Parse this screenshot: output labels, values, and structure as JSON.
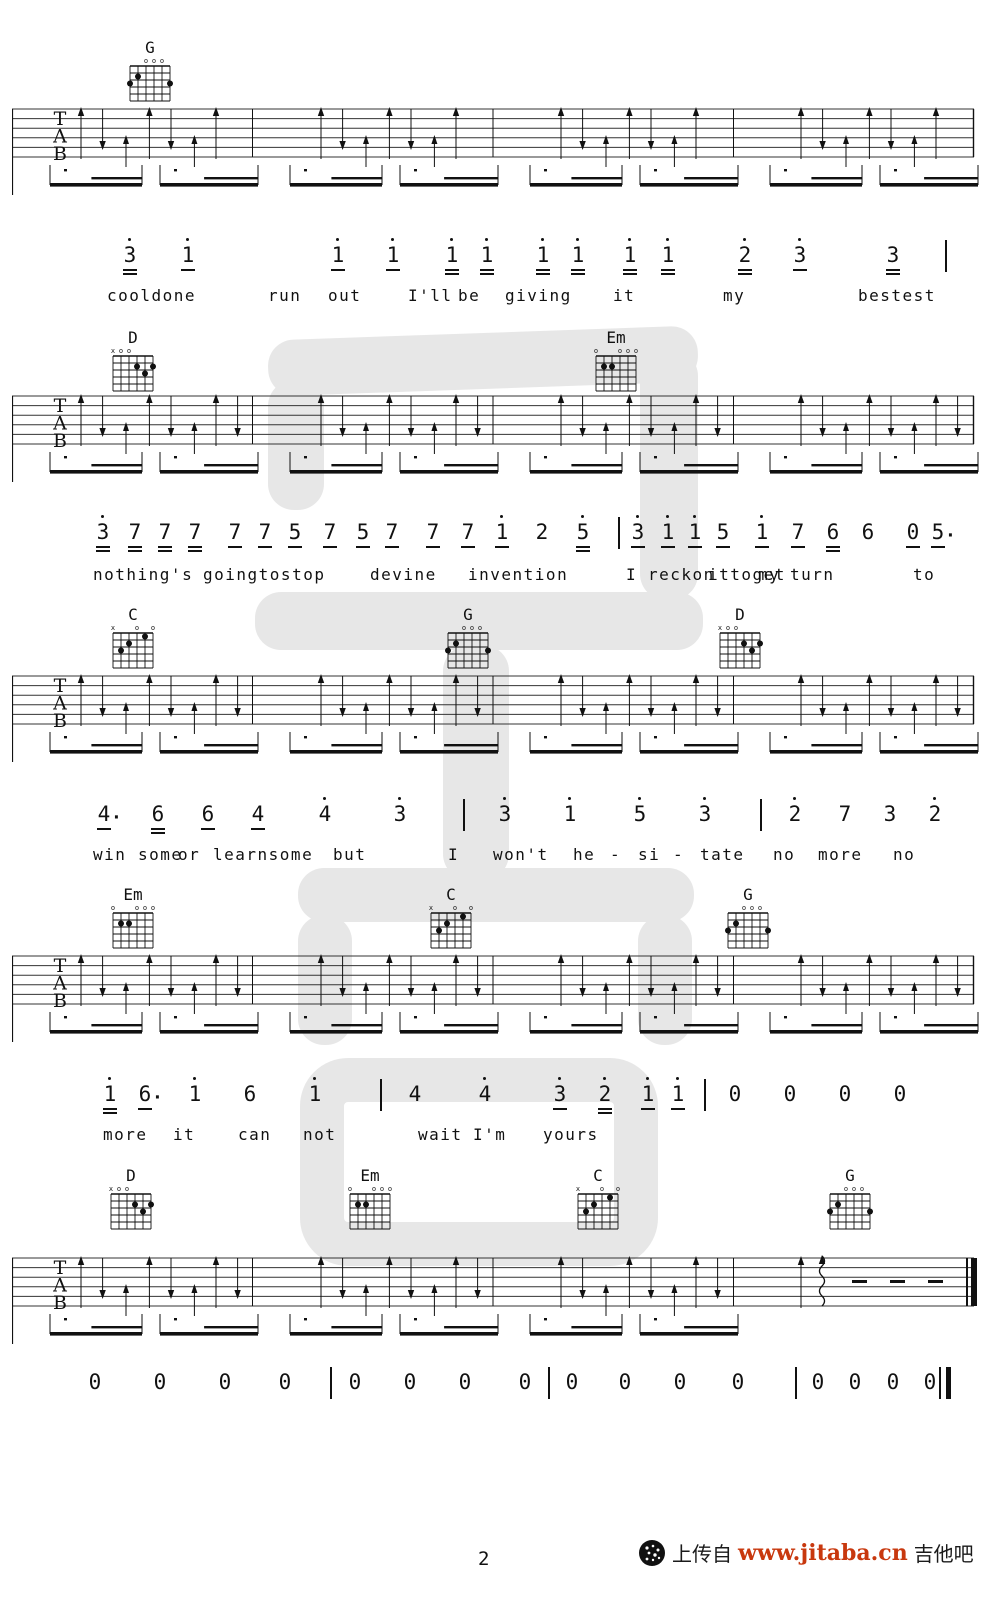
{
  "page": {
    "number": "2"
  },
  "footer": {
    "page_number": "2",
    "logo_icon": "jitaba-logo",
    "upload_text": "上传自",
    "site_url": "www.jitaba.cn",
    "site_name": "吉他吧",
    "url_color": "#c8380e"
  },
  "tab_letters": [
    "T",
    "A",
    "B"
  ],
  "chord_shapes": {
    "G": {
      "markers": [
        "",
        "",
        "o",
        "o",
        "o",
        ""
      ],
      "frets": [
        3,
        2,
        0,
        0,
        0,
        3
      ]
    },
    "D": {
      "markers": [
        "x",
        "o",
        "o",
        "",
        "",
        ""
      ],
      "frets": [
        0,
        0,
        0,
        2,
        3,
        2
      ]
    },
    "Em": {
      "markers": [
        "o",
        "",
        "",
        "o",
        "o",
        "o"
      ],
      "frets": [
        0,
        2,
        2,
        0,
        0,
        0
      ]
    },
    "C": {
      "markers": [
        "x",
        "",
        "",
        "o",
        "",
        "o"
      ],
      "frets": [
        0,
        3,
        2,
        0,
        1,
        0
      ]
    }
  },
  "systems": [
    {
      "chords": [
        {
          "name": "G",
          "x": 122
        }
      ],
      "chord_top": 40,
      "stave_top": 103,
      "arrows_per_measure": 7,
      "final": false,
      "notes_top": 243,
      "lyrics_top": 286,
      "notes": [
        {
          "v": "3",
          "x": 13.0,
          "hi": 1,
          "ul": 2
        },
        {
          "v": "1",
          "x": 18.8,
          "hi": 1,
          "ul": 1
        },
        {
          "v": "1",
          "x": 33.8,
          "hi": 1,
          "ul": 1
        },
        {
          "v": "1",
          "x": 39.3,
          "hi": 1,
          "ul": 1
        },
        {
          "v": "1",
          "x": 45.2,
          "hi": 1,
          "ul": 2
        },
        {
          "v": "1",
          "x": 48.7,
          "hi": 1,
          "ul": 2
        },
        {
          "v": "1",
          "x": 54.3,
          "hi": 1,
          "ul": 2
        },
        {
          "v": "1",
          "x": 57.8,
          "hi": 1,
          "ul": 2
        },
        {
          "v": "1",
          "x": 63.0,
          "hi": 1,
          "ul": 2
        },
        {
          "v": "1",
          "x": 66.8,
          "hi": 1,
          "ul": 2
        },
        {
          "v": "2",
          "x": 74.5,
          "hi": 1,
          "ul": 2
        },
        {
          "v": "3",
          "x": 80.0,
          "hi": 1,
          "ul": 1
        },
        {
          "v": "3",
          "x": 89.3,
          "hi": 0,
          "ul": 2
        }
      ],
      "bars": [
        {
          "x": 94.5,
          "thick": false
        }
      ],
      "lyrics": [
        {
          "t": "cooldone",
          "x": 10.7
        },
        {
          "t": "run",
          "x": 26.8
        },
        {
          "t": "out",
          "x": 32.8
        },
        {
          "t": "I'll",
          "x": 40.8
        },
        {
          "t": "be",
          "x": 45.8
        },
        {
          "t": "giving",
          "x": 50.5
        },
        {
          "t": "it",
          "x": 61.3
        },
        {
          "t": "my",
          "x": 72.3
        },
        {
          "t": "bestest",
          "x": 85.8
        }
      ]
    },
    {
      "chords": [
        {
          "name": "D",
          "x": 105
        },
        {
          "name": "Em",
          "x": 588
        }
      ],
      "chord_top": 330,
      "stave_top": 390,
      "arrows_per_measure": 8,
      "final": false,
      "notes_top": 520,
      "lyrics_top": 565,
      "notes": [
        {
          "v": "3",
          "x": 10.3,
          "hi": 1,
          "ul": 2
        },
        {
          "v": "7",
          "x": 13.5,
          "hi": 0,
          "ul": 2
        },
        {
          "v": "7",
          "x": 16.5,
          "hi": 0,
          "ul": 2
        },
        {
          "v": "7",
          "x": 19.5,
          "hi": 0,
          "ul": 2
        },
        {
          "v": "7",
          "x": 23.5,
          "hi": 0,
          "ul": 1
        },
        {
          "v": "7",
          "x": 26.5,
          "hi": 0,
          "ul": 1
        },
        {
          "v": "5",
          "x": 29.5,
          "hi": 0,
          "ul": 1
        },
        {
          "v": "7",
          "x": 33.0,
          "hi": 0,
          "ul": 1
        },
        {
          "v": "5",
          "x": 36.3,
          "hi": 0,
          "ul": 1
        },
        {
          "v": "7",
          "x": 39.2,
          "hi": 0,
          "ul": 1
        },
        {
          "v": "7",
          "x": 43.3,
          "hi": 0,
          "ul": 1
        },
        {
          "v": "7",
          "x": 46.8,
          "hi": 0,
          "ul": 1
        },
        {
          "v": "1",
          "x": 50.2,
          "hi": 1,
          "ul": 1
        },
        {
          "v": "2",
          "x": 54.2,
          "hi": 0,
          "ul": 0
        },
        {
          "v": "5",
          "x": 58.3,
          "hi": 1,
          "ul": 2
        },
        {
          "v": "3",
          "x": 63.8,
          "hi": 1,
          "ul": 1
        },
        {
          "v": "1",
          "x": 66.8,
          "hi": 1,
          "ul": 1
        },
        {
          "v": "1",
          "x": 69.5,
          "hi": 1,
          "ul": 1
        },
        {
          "v": "5",
          "x": 72.3,
          "hi": 0,
          "ul": 1
        },
        {
          "v": "1",
          "x": 76.2,
          "hi": 1,
          "ul": 1
        },
        {
          "v": "7",
          "x": 79.8,
          "hi": 0,
          "ul": 1
        },
        {
          "v": "6",
          "x": 83.3,
          "hi": 0,
          "ul": 2
        },
        {
          "v": "6",
          "x": 86.8,
          "hi": 0,
          "ul": 0
        },
        {
          "v": "0",
          "x": 91.3,
          "hi": 0,
          "ul": 1
        },
        {
          "v": "5",
          "x": 93.8,
          "hi": 0,
          "ul": 1,
          "dt": 1
        }
      ],
      "bars": [
        {
          "x": 61.8,
          "thick": false
        }
      ],
      "lyrics": [
        {
          "t": "nothing's",
          "x": 9.3
        },
        {
          "t": "goingtostop",
          "x": 20.3
        },
        {
          "t": "devine",
          "x": 37.0
        },
        {
          "t": "invention",
          "x": 46.8
        },
        {
          "t": "I",
          "x": 62.6
        },
        {
          "t": "reckon",
          "x": 64.8
        },
        {
          "t": "ittoget",
          "x": 70.8
        },
        {
          "t": "my",
          "x": 75.8
        },
        {
          "t": "turn",
          "x": 79.0
        },
        {
          "t": "to",
          "x": 91.3
        }
      ]
    },
    {
      "chords": [
        {
          "name": "C",
          "x": 105
        },
        {
          "name": "G",
          "x": 440
        },
        {
          "name": "D",
          "x": 712
        }
      ],
      "chord_top": 607,
      "stave_top": 670,
      "arrows_per_measure": 8,
      "final": false,
      "notes_top": 802,
      "lyrics_top": 845,
      "notes": [
        {
          "v": "4",
          "x": 10.4,
          "hi": 0,
          "ul": 1,
          "dt": 1
        },
        {
          "v": "6",
          "x": 15.8,
          "hi": 0,
          "ul": 2
        },
        {
          "v": "6",
          "x": 20.8,
          "hi": 0,
          "ul": 1
        },
        {
          "v": "4",
          "x": 25.8,
          "hi": 0,
          "ul": 1
        },
        {
          "v": "4",
          "x": 32.5,
          "hi": 1,
          "ul": 0
        },
        {
          "v": "3",
          "x": 40.0,
          "hi": 1,
          "ul": 0
        },
        {
          "v": "3",
          "x": 50.5,
          "hi": 1,
          "ul": 0
        },
        {
          "v": "1",
          "x": 57.0,
          "hi": 1,
          "ul": 0
        },
        {
          "v": "5",
          "x": 64.0,
          "hi": 1,
          "ul": 0
        },
        {
          "v": "3",
          "x": 70.5,
          "hi": 1,
          "ul": 0
        },
        {
          "v": "2",
          "x": 79.5,
          "hi": 1,
          "ul": 0
        },
        {
          "v": "7",
          "x": 84.5,
          "hi": 0,
          "ul": 0
        },
        {
          "v": "3",
          "x": 89.0,
          "hi": 0,
          "ul": 0
        },
        {
          "v": "2",
          "x": 93.5,
          "hi": 1,
          "ul": 0
        }
      ],
      "bars": [
        {
          "x": 46.3,
          "thick": false
        },
        {
          "x": 76.0,
          "thick": false
        }
      ],
      "lyrics": [
        {
          "t": "win",
          "x": 9.3
        },
        {
          "t": "some",
          "x": 13.8
        },
        {
          "t": "or",
          "x": 17.8
        },
        {
          "t": "learnsome",
          "x": 21.3
        },
        {
          "t": "but",
          "x": 33.3
        },
        {
          "t": "I",
          "x": 44.8
        },
        {
          "t": "won't",
          "x": 49.3
        },
        {
          "t": "he",
          "x": 57.3
        },
        {
          "t": "-",
          "x": 61.0
        },
        {
          "t": "si",
          "x": 63.8
        },
        {
          "t": "-",
          "x": 67.3
        },
        {
          "t": "tate",
          "x": 70.0
        },
        {
          "t": "no",
          "x": 77.3
        },
        {
          "t": "more",
          "x": 81.8
        },
        {
          "t": "no",
          "x": 89.3
        }
      ]
    },
    {
      "chords": [
        {
          "name": "Em",
          "x": 105
        },
        {
          "name": "C",
          "x": 423
        },
        {
          "name": "G",
          "x": 720
        }
      ],
      "chord_top": 887,
      "stave_top": 950,
      "arrows_per_measure": 8,
      "final": false,
      "notes_top": 1082,
      "lyrics_top": 1125,
      "notes": [
        {
          "v": "1",
          "x": 11.0,
          "hi": 1,
          "ul": 2
        },
        {
          "v": "6",
          "x": 14.5,
          "hi": 0,
          "ul": 1,
          "dt": 1
        },
        {
          "v": "1",
          "x": 19.5,
          "hi": 1,
          "ul": 0
        },
        {
          "v": "6",
          "x": 25.0,
          "hi": 0,
          "ul": 0
        },
        {
          "v": "1",
          "x": 31.5,
          "hi": 1,
          "ul": 0
        },
        {
          "v": "4",
          "x": 41.5,
          "hi": 0,
          "ul": 0
        },
        {
          "v": "4",
          "x": 48.5,
          "hi": 1,
          "ul": 0
        },
        {
          "v": "3",
          "x": 56.0,
          "hi": 1,
          "ul": 1
        },
        {
          "v": "2",
          "x": 60.5,
          "hi": 1,
          "ul": 2
        },
        {
          "v": "1",
          "x": 64.8,
          "hi": 1,
          "ul": 1
        },
        {
          "v": "1",
          "x": 67.8,
          "hi": 1,
          "ul": 1
        },
        {
          "v": "0",
          "x": 73.5,
          "hi": 0,
          "ul": 0
        },
        {
          "v": "0",
          "x": 79.0,
          "hi": 0,
          "ul": 0
        },
        {
          "v": "0",
          "x": 84.5,
          "hi": 0,
          "ul": 0
        },
        {
          "v": "0",
          "x": 90.0,
          "hi": 0,
          "ul": 0
        }
      ],
      "bars": [
        {
          "x": 38.0,
          "thick": false
        },
        {
          "x": 70.4,
          "thick": false
        }
      ],
      "lyrics": [
        {
          "t": "more",
          "x": 10.3
        },
        {
          "t": "it",
          "x": 17.3
        },
        {
          "t": "can",
          "x": 23.8
        },
        {
          "t": "not",
          "x": 30.3
        },
        {
          "t": "wait",
          "x": 41.8
        },
        {
          "t": "I'm",
          "x": 47.3
        },
        {
          "t": "yours",
          "x": 54.3
        }
      ]
    },
    {
      "chords": [
        {
          "name": "D",
          "x": 103
        },
        {
          "name": "Em",
          "x": 342
        },
        {
          "name": "C",
          "x": 570
        },
        {
          "name": "G",
          "x": 822
        }
      ],
      "chord_top": 1168,
      "stave_top": 1252,
      "arrows_per_measure": 8,
      "final": true,
      "notes_top": 1370,
      "lyrics_top": 1412,
      "notes": [
        {
          "v": "0",
          "x": 9.5,
          "hi": 0,
          "ul": 0
        },
        {
          "v": "0",
          "x": 16.0,
          "hi": 0,
          "ul": 0
        },
        {
          "v": "0",
          "x": 22.5,
          "hi": 0,
          "ul": 0
        },
        {
          "v": "0",
          "x": 28.5,
          "hi": 0,
          "ul": 0
        },
        {
          "v": "0",
          "x": 35.5,
          "hi": 0,
          "ul": 0
        },
        {
          "v": "0",
          "x": 41.0,
          "hi": 0,
          "ul": 0
        },
        {
          "v": "0",
          "x": 46.5,
          "hi": 0,
          "ul": 0
        },
        {
          "v": "0",
          "x": 52.5,
          "hi": 0,
          "ul": 0
        },
        {
          "v": "0",
          "x": 57.2,
          "hi": 0,
          "ul": 0
        },
        {
          "v": "0",
          "x": 62.5,
          "hi": 0,
          "ul": 0
        },
        {
          "v": "0",
          "x": 68.0,
          "hi": 0,
          "ul": 0
        },
        {
          "v": "0",
          "x": 73.8,
          "hi": 0,
          "ul": 0
        },
        {
          "v": "0",
          "x": 81.8,
          "hi": 0,
          "ul": 0
        },
        {
          "v": "0",
          "x": 85.5,
          "hi": 0,
          "ul": 0
        },
        {
          "v": "0",
          "x": 89.3,
          "hi": 0,
          "ul": 0
        },
        {
          "v": "0",
          "x": 93.0,
          "hi": 0,
          "ul": 0
        }
      ],
      "bars": [
        {
          "x": 33.0,
          "thick": false
        },
        {
          "x": 54.8,
          "thick": false
        },
        {
          "x": 79.5,
          "thick": false
        },
        {
          "x": 94.6,
          "thick": true
        }
      ],
      "lyrics": []
    }
  ]
}
